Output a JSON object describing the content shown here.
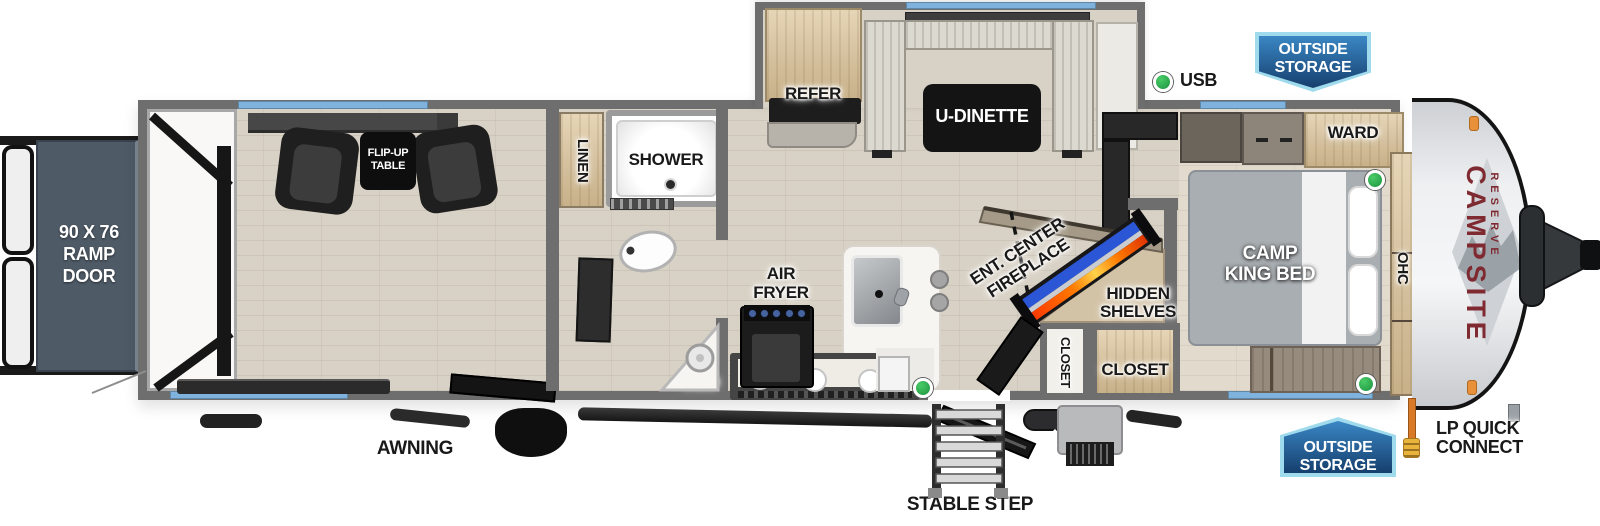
{
  "floorplan": {
    "model": "CAMPSITE",
    "series": "RESERVE",
    "type": "travel trailer floor plan, side profile top-down view"
  },
  "labels": {
    "ramp_door": [
      "90 X 76",
      "RAMP",
      "DOOR"
    ],
    "flip_up_table": [
      "FLIP-UP",
      "TABLE"
    ],
    "linen": "LINEN",
    "shower": "SHOWER",
    "med": "MED",
    "refer": "REFER",
    "u_dinette": "U-DINETTE",
    "air_fryer": [
      "AIR",
      "FRYER"
    ],
    "ent_center_fireplace": [
      "ENT. CENTER",
      "FIREPLACE"
    ],
    "hidden_shelves": [
      "HIDDEN",
      "SHELVES"
    ],
    "closet_small": "CLOSET",
    "closet_large": "CLOSET",
    "ward": "WARD",
    "camp_king_bed": [
      "CAMP",
      "KING BED"
    ],
    "ohc": "OHC",
    "usb": "USB",
    "outside_storage": [
      "OUTSIDE",
      "STORAGE"
    ],
    "awning": "AWNING",
    "stable_step": "STABLE STEP",
    "lp_quick_connect": [
      "LP QUICK",
      "CONNECT"
    ]
  },
  "indicators": {
    "usb_marker_count": 4,
    "usb_marker_color": "#2fb04c"
  },
  "colors": {
    "wall": "#6e6e6e",
    "window_glass": "#7fb3dd",
    "badge_border": "#9fdbec",
    "badge_fill_top": "#3a87c4",
    "badge_fill_bottom": "#163f6e",
    "brand_text": "#7e2a30",
    "fireplace_led": "#2b57d6",
    "fireplace_flame": "#ff7a00",
    "lp_hose": "#d97a28",
    "ramp_door_fill": "#4e5a66"
  }
}
